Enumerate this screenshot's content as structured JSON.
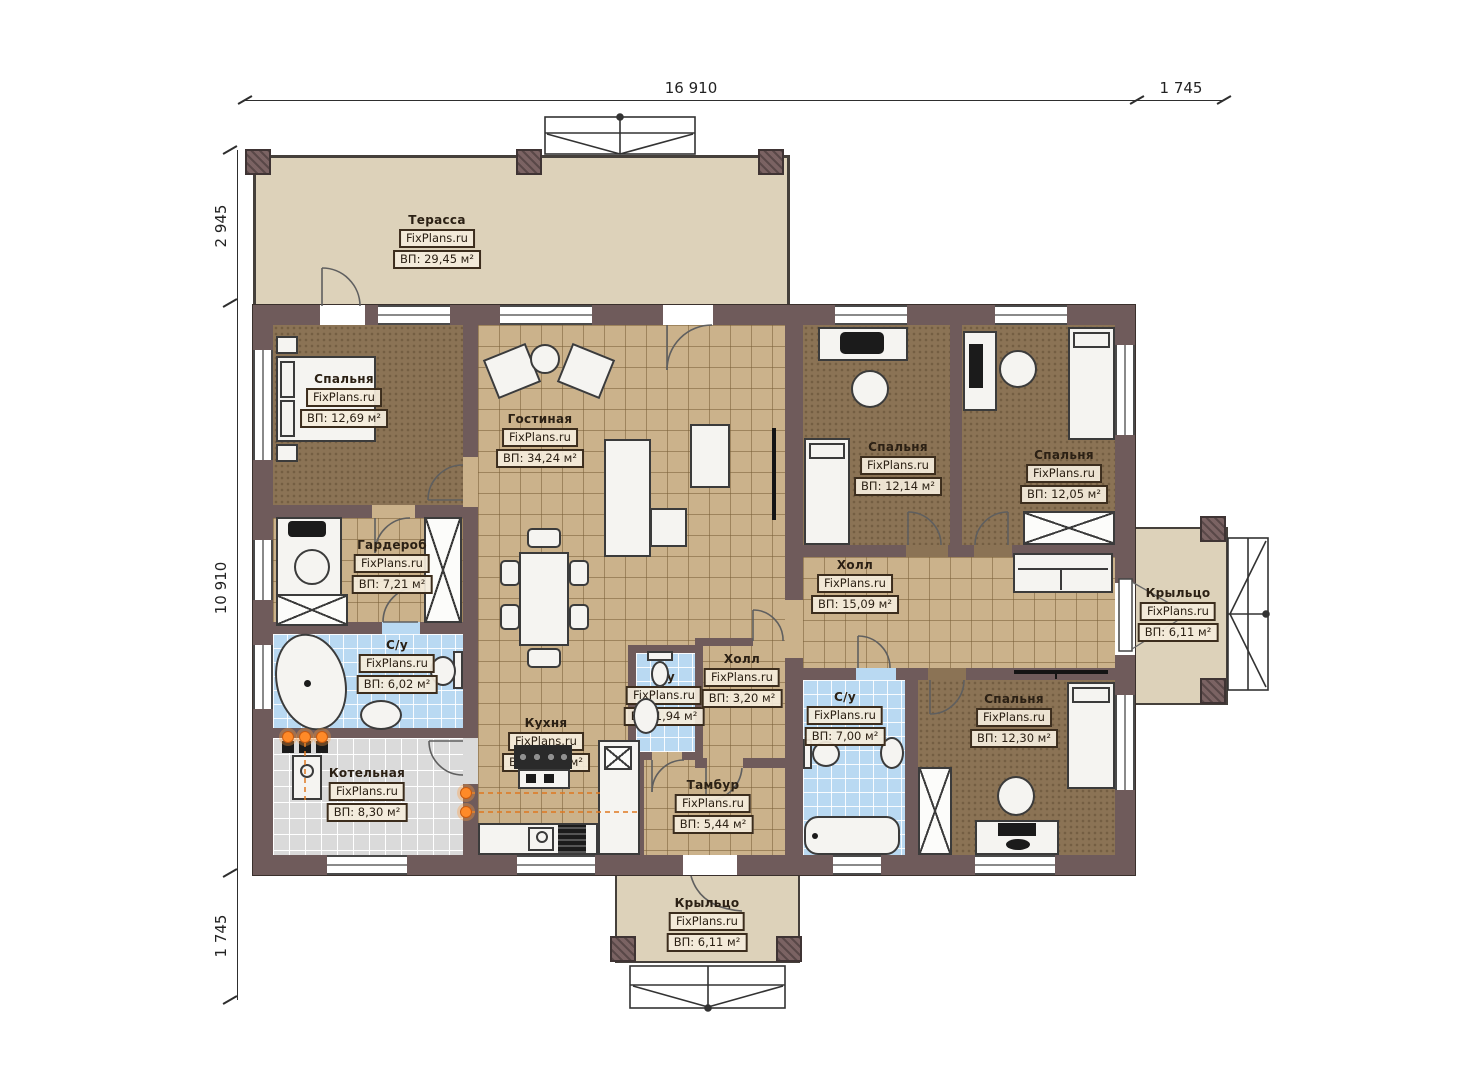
{
  "dimensions": {
    "top": [
      "16 910",
      "1 745"
    ],
    "left": [
      "2 945",
      "10 910",
      "1 745"
    ]
  },
  "colors": {
    "wall": "#6f5b5b",
    "terrace_floor": "#ddd2ba",
    "bedroom_floor": "#8b7355",
    "tile_floor": "#cbb28b",
    "bath_floor": "#b9d9f2",
    "boiler_floor": "#dadada",
    "heating_accent": "#f08224"
  },
  "rooms": {
    "terrace": {
      "name": "Терасса",
      "brand": "FixPlans.ru",
      "area": "ВП: 29,45 м²"
    },
    "bedroom1": {
      "name": "Спальня",
      "brand": "FixPlans.ru",
      "area": "ВП: 12,69 м²"
    },
    "living": {
      "name": "Гостиная",
      "brand": "FixPlans.ru",
      "area": "ВП: 34,24 м²"
    },
    "wardrobe": {
      "name": "Гардероб",
      "brand": "FixPlans.ru",
      "area": "ВП: 7,21 м²"
    },
    "bath1": {
      "name": "С/у",
      "brand": "FixPlans.ru",
      "area": "ВП: 6,02 м²"
    },
    "boiler": {
      "name": "Котельная",
      "brand": "FixPlans.ru",
      "area": "ВП: 8,30 м²"
    },
    "kitchen": {
      "name": "Кухня",
      "brand": "FixPlans.ru",
      "area": "ВП: 10,11 м²"
    },
    "wc_small": {
      "name": "С/у",
      "brand": "FixPlans.ru",
      "area": "ВП: 1,94 м²"
    },
    "hall_small": {
      "name": "Холл",
      "brand": "FixPlans.ru",
      "area": "ВП: 3,20 м²"
    },
    "tambur": {
      "name": "Тамбур",
      "brand": "FixPlans.ru",
      "area": "ВП: 5,44 м²"
    },
    "bedroom2": {
      "name": "Спальня",
      "brand": "FixPlans.ru",
      "area": "ВП: 12,14 м²"
    },
    "bedroom3": {
      "name": "Спальня",
      "brand": "FixPlans.ru",
      "area": "ВП: 12,05 м²"
    },
    "hall": {
      "name": "Холл",
      "brand": "FixPlans.ru",
      "area": "ВП: 15,09 м²"
    },
    "bath2": {
      "name": "С/у",
      "brand": "FixPlans.ru",
      "area": "ВП: 7,00 м²"
    },
    "bedroom4": {
      "name": "Спальня",
      "brand": "FixPlans.ru",
      "area": "ВП: 12,30 м²"
    },
    "porch_right": {
      "name": "Крыльцо",
      "brand": "FixPlans.ru",
      "area": "ВП: 6,11 м²"
    },
    "porch_bottom": {
      "name": "Крыльцо",
      "brand": "FixPlans.ru",
      "area": "ВП: 6,11 м²"
    }
  }
}
